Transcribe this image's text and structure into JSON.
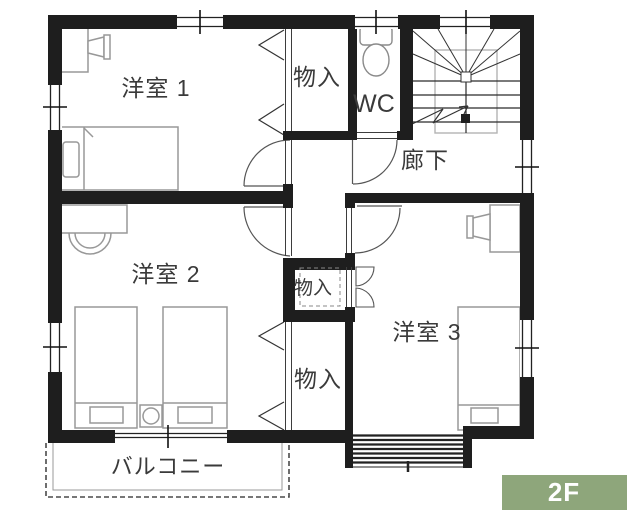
{
  "plan": {
    "title": "2F floor plan",
    "floor_badge": {
      "label": "2F",
      "bg": "#8ea67b",
      "fg": "#ffffff"
    },
    "labels": {
      "room1": "洋室 1",
      "room2": "洋室 2",
      "room3": "洋室 3",
      "closet_top": "物入",
      "closet_mid": "物入",
      "closet_low": "物入",
      "wc": "WC",
      "hallway": "廊下",
      "balcony": "バルコニー"
    },
    "colors": {
      "wall": "#1e1e1e",
      "furniture_line": "#989898",
      "door_line": "#555555",
      "text": "#3a3a3a",
      "badge_bg": "#8ea67b"
    }
  }
}
